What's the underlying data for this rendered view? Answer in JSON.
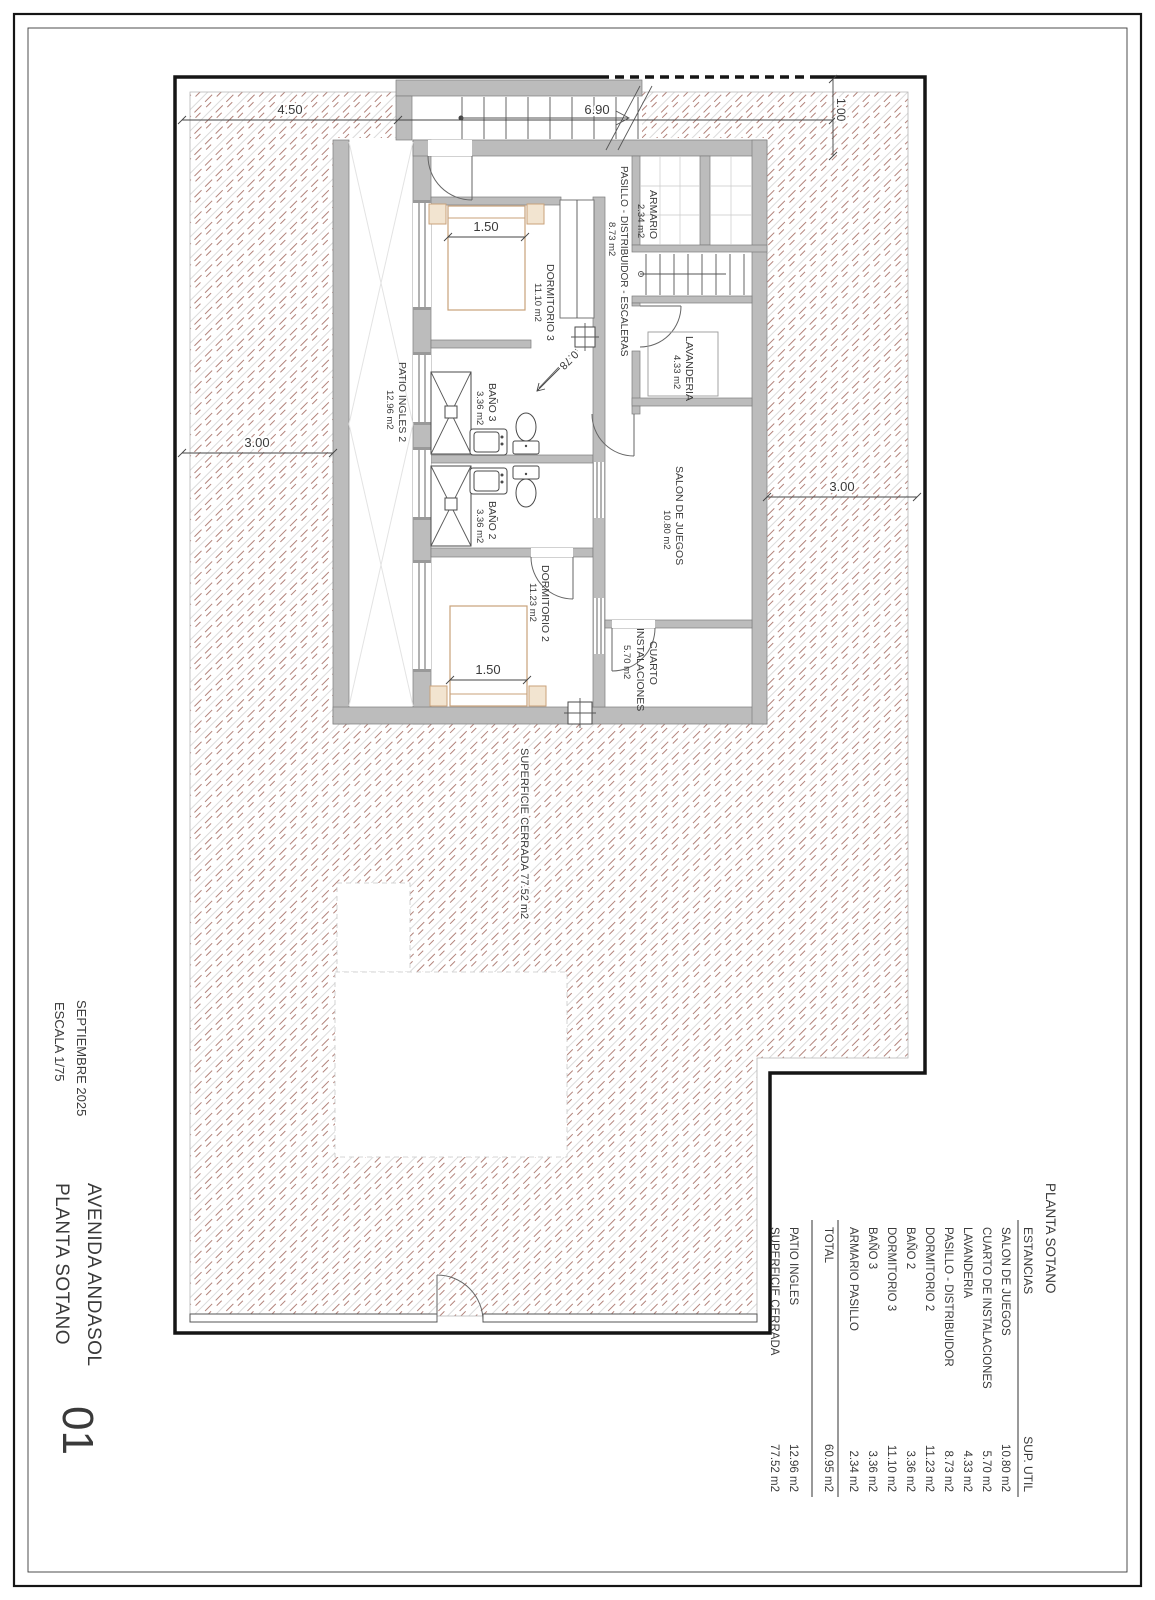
{
  "sheet": {
    "number": "01",
    "project": "AVENIDA ANDASOL",
    "plan": "PLANTA SOTANO",
    "date": "SEPTIEMBRE 2025",
    "scale": "ESCALA 1/75"
  },
  "rooms": {
    "patio": {
      "name": "PATIO INGLES 2",
      "area": "12.96 m2"
    },
    "dormitorio3": {
      "name": "DORMITORIO 3",
      "area": "11.10 m2"
    },
    "bano3": {
      "name": "BAÑO 3",
      "area": "3.36 m2"
    },
    "bano2": {
      "name": "BAÑO 2",
      "area": "3.36 m2"
    },
    "dormitorio2": {
      "name": "DORMITORIO 2",
      "area": "11.23 m2"
    },
    "pasillo": {
      "name": "PASILLO - DISTRIBUIDOR - ESCALERAS",
      "area": "8.73 m2"
    },
    "armario": {
      "name": "ARMARIO",
      "area": "2.34 m2"
    },
    "lavanderia": {
      "name": "LAVANDERIA",
      "area": "4.33 m2"
    },
    "salon": {
      "name": "SALON DE JUEGOS",
      "area": "10.80 m2"
    },
    "cuarto": {
      "line1": "CUARTO",
      "line2": "INSTALACIONES",
      "area": "5.70 m2"
    }
  },
  "annotations": {
    "superficie_cerrada": "SUPERFICIE CERRADA 77.52 m2"
  },
  "dimensions": {
    "top_left": "4.50",
    "top_center": "6.90",
    "top_right": "1.00",
    "left": "3.00",
    "right": "3.00",
    "bed3": "1.50",
    "bed2": "1.50",
    "door": "0.78"
  },
  "legend_table": {
    "title": "PLANTA SOTANO",
    "columns": {
      "room": "ESTANCIAS",
      "area": "SUP. UTIL"
    },
    "rows": [
      {
        "name": "SALON DE JUEGOS",
        "area": "10.80 m2"
      },
      {
        "name": "CUARTO DE INSTALACIONES",
        "area": "5.70 m2"
      },
      {
        "name": "LAVANDERIA",
        "area": "4.33 m2"
      },
      {
        "name": "PASILLO - DISTRIBUIDOR",
        "area": "8.73 m2"
      },
      {
        "name": "DORMITORIO 2",
        "area": "11.23 m2"
      },
      {
        "name": "BAÑO 2",
        "area": "3.36 m2"
      },
      {
        "name": "DORMITORIO 3",
        "area": "11.10 m2"
      },
      {
        "name": "BAÑO 3",
        "area": "3.36 m2"
      },
      {
        "name": "ARMARIO PASILLO",
        "area": "2.34 m2"
      }
    ],
    "total": {
      "name": "TOTAL",
      "area": "60.95 m2"
    },
    "extras": [
      {
        "name": "PATIO INGLES",
        "area": "12.96 m2"
      },
      {
        "name": "SUPERFICIE CERRADA",
        "area": "77.52 m2"
      }
    ]
  },
  "colors": {
    "earth_hatch_red": "#b2837b",
    "earth_hatch_gray": "#c9c9c9",
    "wall_fill": "#bcbcbc",
    "furniture_tan": "#c9a27a",
    "line": "#3a3a3a"
  }
}
